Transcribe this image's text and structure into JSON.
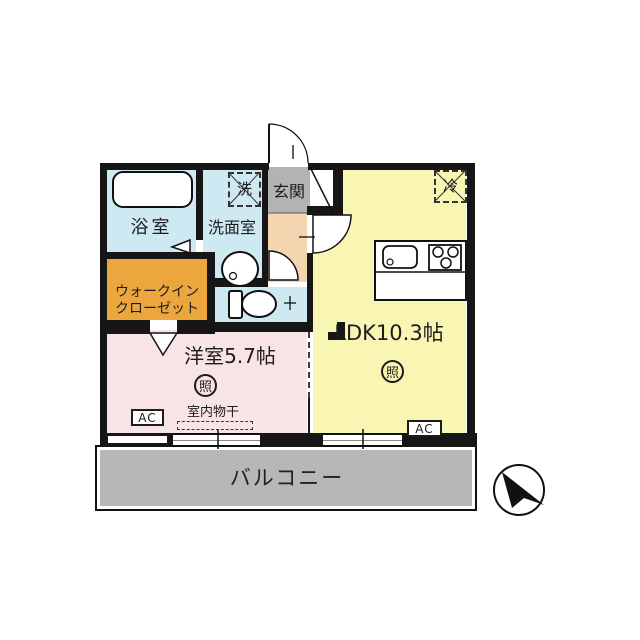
{
  "plan": {
    "title_hidden": "",
    "rooms": {
      "bathroom": {
        "label": "浴室"
      },
      "washroom": {
        "label": "洗面室"
      },
      "washer_box": {
        "label": "洗"
      },
      "entrance": {
        "label": "玄関"
      },
      "fridge_box": {
        "label": "冷"
      },
      "walk_in_closet": {
        "label_line1": "ウォークイン",
        "label_line2": "クローゼット"
      },
      "western_room": {
        "label": "洋室5.7帖",
        "light_symbol": "照",
        "ac_label": "AC",
        "indoor_drying_label": "室内物干"
      },
      "ldk": {
        "label": "LDK10.3帖",
        "light_symbol": "照",
        "ac_label": "AC"
      },
      "balcony": {
        "label": "バルコニー"
      }
    },
    "icons": {
      "north_arrow": "north-arrow-icon"
    },
    "colors": {
      "wet_area_blue": "#cfe9f2",
      "closet_orange": "#eba73e",
      "bedroom_pink": "#f8e3e6",
      "ldk_yellow": "#f9f5b2",
      "entrance_gray": "#b3b3b3",
      "hallway_beige": "#f3d6b0",
      "balcony_gray": "#b7b7b7",
      "wall_black": "#161616"
    }
  }
}
